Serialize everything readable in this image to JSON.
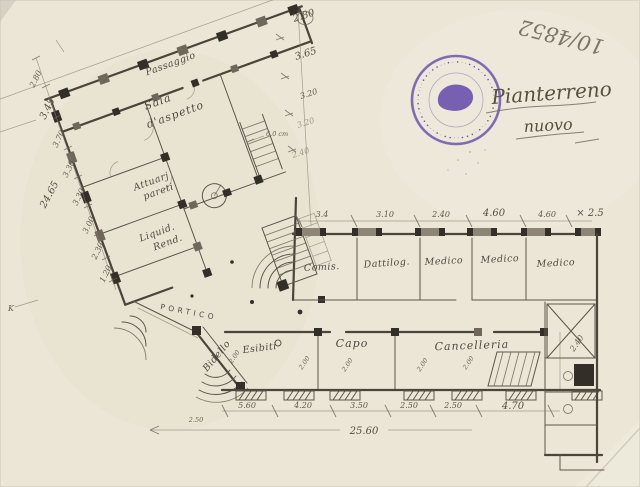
{
  "colors": {
    "paper": "#ece6d6",
    "pencil": "#5c5548",
    "ink_dark": "#3a342c",
    "stamp_violet": "#5b3fa8"
  },
  "annotations": {
    "archive_number": "10/4852",
    "plan_title": "Pianterreno",
    "plan_subtitle": "nuovo",
    "k_mark": "K",
    "wall_note": "6.0 cm"
  },
  "stamp": {
    "ring_marks": "•··•••·••·•···••·••··•·•••··••·•··•••·••·•···••·••··•·•••··••·•··"
  },
  "rooms": {
    "passaggio": "Passaggio",
    "sala_1": "Sala",
    "sala_2": "d'aspetto",
    "attuari_1": "Attuarj",
    "attuari_2": "pareti",
    "liquid_1": "Liquid.",
    "liquid_2": "Rend.",
    "portico": "PORTICO",
    "bidello": "Bidello",
    "esibiti": "Esibiti",
    "capo": "Capo",
    "cancelleria": "Cancelleria",
    "comis": "Comis.",
    "dattilog": "Dattilog.",
    "medico_1": "Medico",
    "medico_2": "Medico",
    "medico_3": "Medico"
  },
  "dims": {
    "top_row": [
      "3.4",
      "3.10",
      "2.40",
      "4.60",
      "4.60",
      "× 2.5"
    ],
    "bottom_row": [
      "5.60",
      "4.20",
      "3.50",
      "2.50",
      "2.50",
      "4.70"
    ],
    "bottom_sub": "2.50",
    "bottom_total": "25.60",
    "left_chain": [
      "2.80",
      "3.45",
      "3.70",
      "3.30",
      "3.30",
      "3.00",
      "2.30",
      "1.20"
    ],
    "left_total": "24.65",
    "right_chain": [
      "2.80",
      "3.65",
      "3.20",
      "3.20",
      "2.40"
    ],
    "room_heights": [
      "2.00",
      "2.00",
      "2.00",
      "2.00",
      "2.00"
    ],
    "right_room_height": "2.40"
  }
}
